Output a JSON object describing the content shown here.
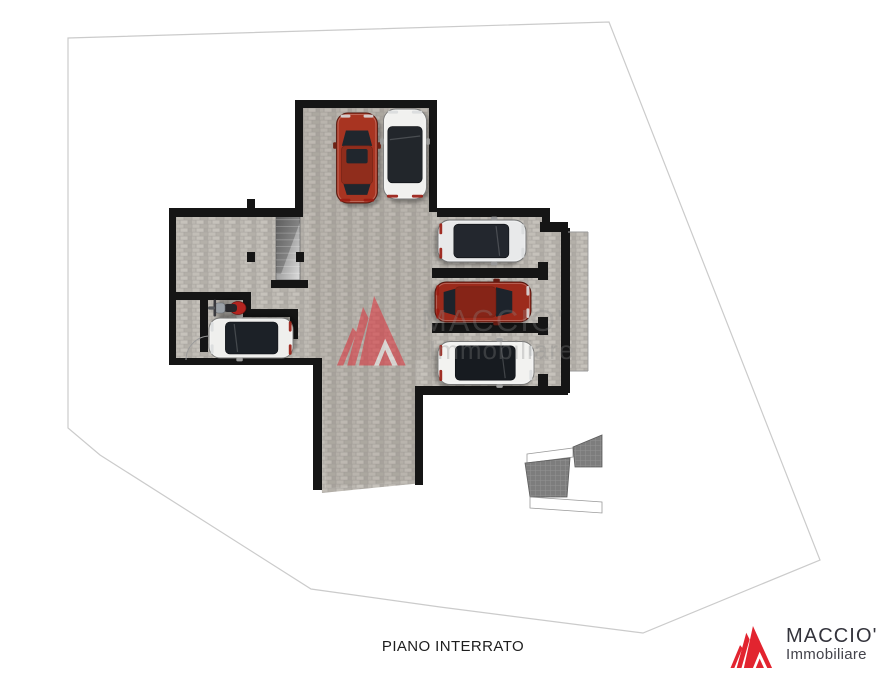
{
  "page": {
    "width": 880,
    "height": 680,
    "background": "#ffffff"
  },
  "footer": {
    "plan_label": "PIANO INTERRATO"
  },
  "brand": {
    "name": "MACCIO'",
    "subtitle": "Immobiliare",
    "logo_red": "#e2242f",
    "text_color": "#34343c",
    "subtitle_color": "#43434b"
  },
  "watermark": {
    "line1": "MACCIO'",
    "line2": "Immobiliare",
    "text_color": "#8c8c8c",
    "logo_opacity": 0.5,
    "text_opacity": 0.3,
    "logo_x": 333,
    "logo_y": 296,
    "logo_scale": 0.79,
    "line1_x": 421,
    "line1_y": 331,
    "line1_size": 31,
    "line2_x": 429,
    "line2_y": 359,
    "line2_size": 26
  },
  "palette": {
    "wall": "#151515",
    "mortar": "#a9a5a0",
    "boundary": "#cbcbcb",
    "structure_gray": "#7d7d7d",
    "tint": "rgba(104,92,74,0.09)",
    "thin_line": "#9a9a9a"
  },
  "plan": {
    "boundary_points": "68,38 609,22 820,560 643,633 440,607 311,589 100,455 68,428",
    "floors": [
      {
        "type": "rect",
        "x": 295,
        "y": 100,
        "w": 142,
        "h": 117
      },
      {
        "type": "rect",
        "x": 172,
        "y": 208,
        "w": 378,
        "h": 157
      },
      {
        "type": "rect",
        "x": 546,
        "y": 228,
        "w": 16,
        "h": 162
      },
      {
        "type": "rect",
        "x": 415,
        "y": 300,
        "w": 133,
        "h": 95
      },
      {
        "type": "poly",
        "points": "313,358 423,358 423,483 322,493"
      },
      {
        "type": "rect",
        "x": 552,
        "y": 232,
        "w": 36,
        "h": 139
      }
    ],
    "tints": [
      {
        "type": "rect",
        "x": 303,
        "y": 108,
        "w": 126,
        "h": 106
      },
      {
        "type": "rect",
        "x": 309,
        "y": 214,
        "w": 121,
        "h": 146
      },
      {
        "type": "poly",
        "points": "322,360 415,360 415,480 326,488"
      }
    ],
    "walls": [
      [
        295,
        100,
        142,
        8
      ],
      [
        295,
        100,
        8,
        113
      ],
      [
        429,
        100,
        8,
        112
      ],
      [
        169,
        208,
        134,
        9
      ],
      [
        247,
        199,
        8,
        9
      ],
      [
        169,
        208,
        7,
        157
      ],
      [
        169,
        358,
        153,
        7
      ],
      [
        313,
        358,
        9,
        132
      ],
      [
        415,
        392,
        8,
        93
      ],
      [
        415,
        386,
        153,
        9
      ],
      [
        176,
        292,
        75,
        8
      ],
      [
        243,
        292,
        8,
        25
      ],
      [
        243,
        309,
        55,
        8
      ],
      [
        290,
        309,
        8,
        30
      ],
      [
        200,
        300,
        8,
        52
      ],
      [
        247,
        252,
        8,
        10
      ],
      [
        296,
        252,
        8,
        10
      ],
      [
        271,
        280,
        37,
        8
      ],
      [
        437,
        208,
        113,
        9
      ],
      [
        542,
        208,
        8,
        24
      ],
      [
        540,
        222,
        28,
        10
      ],
      [
        561,
        228,
        9,
        165
      ],
      [
        432,
        268,
        116,
        10
      ],
      [
        432,
        323,
        116,
        10
      ],
      [
        538,
        262,
        10,
        18
      ],
      [
        538,
        317,
        10,
        18
      ],
      [
        538,
        374,
        10,
        14
      ]
    ],
    "stair": {
      "x": 276,
      "y": 213,
      "w": 24,
      "h": 67,
      "steps": 10
    },
    "thin_lines": [
      "M186,360 A24,24 0 0 1 210,336",
      "M568,232 L588,232",
      "M588,232 L588,371",
      "M570,371 L588,371"
    ],
    "structures": [
      {
        "points": "527,454 573,448 573,457 527,463",
        "fill": "#ffffff",
        "stroke": "#9a9a9a"
      },
      {
        "points": "573,447 602,435 602,467 575,467",
        "fill": "grid",
        "stroke": "#5e5e5e"
      },
      {
        "points": "525,463 570,458 567,497 530,497",
        "fill": "grid",
        "stroke": "#5e5e5e"
      },
      {
        "points": "530,497 602,502 602,513 530,508",
        "fill": "#ffffff",
        "stroke": "#9a9a9a"
      }
    ],
    "cars": [
      {
        "id": "suv-red",
        "x": 357,
        "y": 158,
        "len": 90,
        "wid": 41,
        "dir": "up",
        "body": "#a83421",
        "glass": "#20262d",
        "roof": "solid",
        "sunroof": true
      },
      {
        "id": "suv-white",
        "x": 405,
        "y": 154,
        "len": 90,
        "wid": 43,
        "dir": "up",
        "body": "#f1f1ef",
        "glass": "#22262b",
        "roof": "glass"
      },
      {
        "id": "car-silver",
        "x": 482,
        "y": 241,
        "len": 88,
        "wid": 42,
        "dir": "right",
        "body": "#e8e9ea",
        "glass": "#23272e",
        "roof": "glass"
      },
      {
        "id": "car-red",
        "x": 483,
        "y": 302,
        "len": 96,
        "wid": 40,
        "dir": "right",
        "body": "#9c2a1b",
        "glass": "#1d232b",
        "roof": "solid",
        "sunroof": false
      },
      {
        "id": "car-white-bottom",
        "x": 486,
        "y": 363,
        "len": 96,
        "wid": 43,
        "dir": "right",
        "body": "#f2f2f0",
        "glass": "#171b20",
        "roof": "glass"
      },
      {
        "id": "car-white-left",
        "x": 251,
        "y": 338,
        "len": 84,
        "wid": 40,
        "dir": "left",
        "body": "#efefed",
        "glass": "#1c2127",
        "roof": "glass"
      }
    ],
    "moto": {
      "id": "motorcycle",
      "x": 227,
      "y": 308,
      "body": "#b3241f"
    }
  }
}
